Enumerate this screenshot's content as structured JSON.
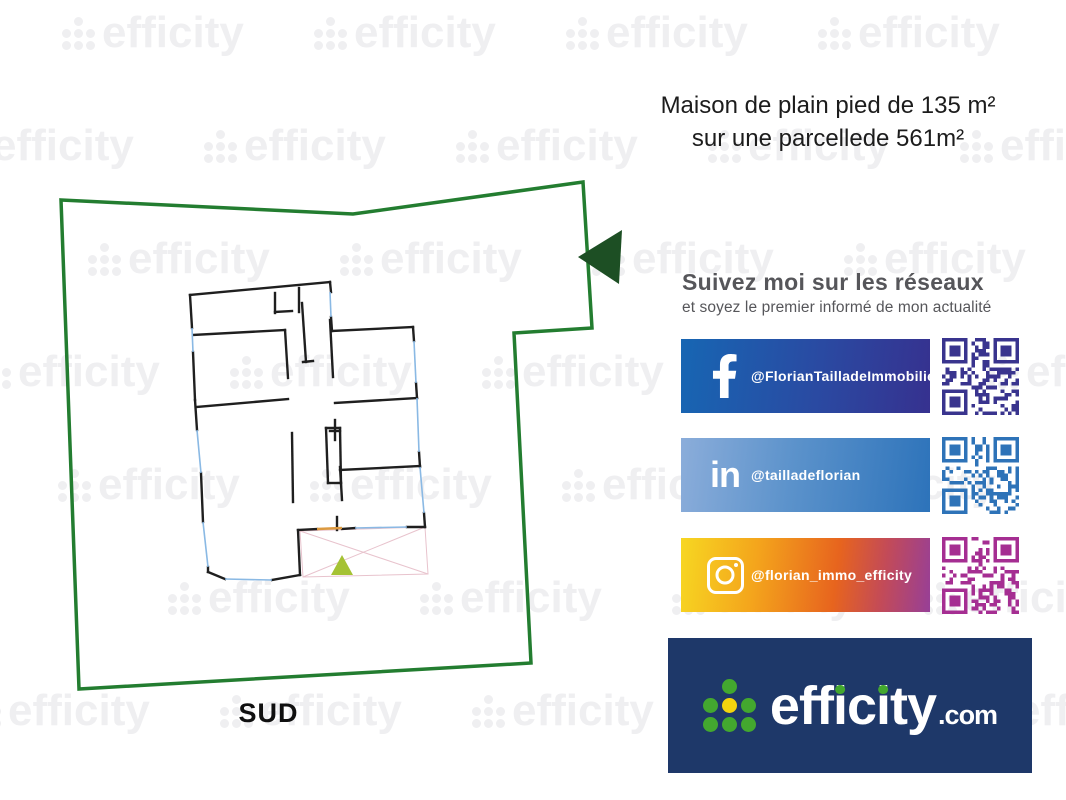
{
  "title": {
    "line1": "Maison de plain pied de 135 m²",
    "line2": "sur une parcellede 561m²"
  },
  "plan": {
    "south_label": "SUD",
    "colors": {
      "plot": "#237d30",
      "arrow": "#1d4f24",
      "wall": "#1f1f1f",
      "window": "#8ab9e4",
      "terrace": "#e8c3cd",
      "triangle": "#a5c234",
      "orange": "#dc9a40"
    },
    "plot_polygon": [
      [
        61,
        200
      ],
      [
        353,
        214
      ],
      [
        583,
        182
      ],
      [
        592,
        328
      ],
      [
        514,
        333
      ],
      [
        531,
        663
      ],
      [
        79,
        689
      ]
    ],
    "arrow_polygon": [
      [
        578,
        257
      ],
      [
        622,
        230
      ],
      [
        619,
        284
      ]
    ],
    "walls": [
      [
        190,
        295,
        330,
        282
      ],
      [
        275,
        293,
        275,
        313
      ],
      [
        275,
        312,
        292,
        311
      ],
      [
        299,
        288,
        299,
        312
      ],
      [
        330,
        282,
        331,
        292
      ],
      [
        331,
        317,
        332,
        331
      ],
      [
        332,
        331,
        413,
        327
      ],
      [
        413,
        327,
        414,
        341
      ],
      [
        416,
        383,
        417,
        398
      ],
      [
        335,
        403,
        417,
        398
      ],
      [
        419,
        452,
        420,
        467
      ],
      [
        340,
        470,
        420,
        466
      ],
      [
        424,
        513,
        425,
        527
      ],
      [
        425,
        527,
        407,
        527
      ],
      [
        355,
        528,
        342,
        529
      ],
      [
        317,
        529,
        298,
        530
      ],
      [
        298,
        530,
        300,
        575
      ],
      [
        300,
        575,
        272,
        580
      ],
      [
        225,
        579,
        208,
        572
      ],
      [
        190,
        295,
        192,
        328
      ],
      [
        193,
        352,
        195,
        400
      ],
      [
        195,
        400,
        197,
        430
      ],
      [
        201,
        473,
        203,
        522
      ],
      [
        208,
        567,
        208,
        572
      ],
      [
        193,
        335,
        285,
        330
      ],
      [
        285,
        330,
        288,
        378
      ],
      [
        197,
        407,
        288,
        399
      ],
      [
        302,
        303,
        306,
        362
      ],
      [
        303,
        362,
        313,
        361
      ],
      [
        330,
        320,
        333,
        377
      ],
      [
        340,
        467,
        342,
        500
      ],
      [
        292,
        433,
        293,
        502
      ],
      [
        326,
        428,
        340,
        428
      ],
      [
        340,
        428,
        341,
        483
      ],
      [
        341,
        483,
        328,
        483
      ],
      [
        326,
        428,
        328,
        483
      ],
      [
        337,
        517,
        337,
        530
      ],
      [
        335,
        420,
        335,
        440
      ],
      [
        330,
        431,
        340,
        431
      ]
    ],
    "windows": [
      [
        330,
        292,
        331,
        317
      ],
      [
        414,
        341,
        416,
        383
      ],
      [
        417,
        398,
        419,
        452
      ],
      [
        420,
        467,
        424,
        513
      ],
      [
        407,
        527,
        355,
        528
      ],
      [
        272,
        580,
        225,
        579
      ],
      [
        192,
        328,
        193,
        352
      ],
      [
        197,
        430,
        201,
        473
      ],
      [
        203,
        522,
        208,
        567
      ]
    ],
    "terrace_outline": [
      [
        300,
        531
      ],
      [
        425,
        527
      ],
      [
        428,
        574
      ],
      [
        303,
        577
      ]
    ],
    "terrace_diagonals": [
      [
        300,
        531,
        428,
        574
      ],
      [
        425,
        527,
        303,
        577
      ]
    ],
    "entrance_triangle": [
      [
        342,
        555
      ],
      [
        331,
        575
      ],
      [
        353,
        575
      ]
    ],
    "orange_segment": [
      317,
      529,
      342,
      528
    ]
  },
  "social": {
    "heading": "Suivez moi sur les réseaux",
    "subheading": "et soyez le premier informé de mon actualité",
    "items": [
      {
        "network": "facebook",
        "icon": "facebook-f-icon",
        "handle": "@FlorianTailladeImmobilier",
        "gradient": [
          [
            "#1766b3",
            "0%"
          ],
          [
            "#2a4aa2",
            "55%"
          ],
          [
            "#36318f",
            "100%"
          ]
        ],
        "qr_color": "#39348e"
      },
      {
        "network": "linkedin",
        "icon": "linkedin-in-icon",
        "handle": "@tailladeflorian",
        "gradient": [
          [
            "#8badda",
            "0%"
          ],
          [
            "#5b92cb",
            "45%"
          ],
          [
            "#2d73ba",
            "100%"
          ]
        ],
        "qr_color": "#2e73b8"
      },
      {
        "network": "instagram",
        "icon": "instagram-camera-icon",
        "handle": "@florian_immo_efficity",
        "gradient": [
          [
            "#f7d722",
            "0%"
          ],
          [
            "#f4a51c",
            "30%"
          ],
          [
            "#e7641e",
            "62%"
          ],
          [
            "#c44b56",
            "80%"
          ],
          [
            "#973f97",
            "100%"
          ]
        ],
        "qr_color": "#a52e92"
      }
    ]
  },
  "brand": {
    "logo_text": "efficity",
    "logo_suffix": ".com",
    "background": "#1e3869",
    "dot_green": "#43a82f",
    "dot_yellow": "#f2d40e",
    "text_color": "#ffffff"
  },
  "watermark": {
    "text": "efficity",
    "color": "#efeff1"
  }
}
